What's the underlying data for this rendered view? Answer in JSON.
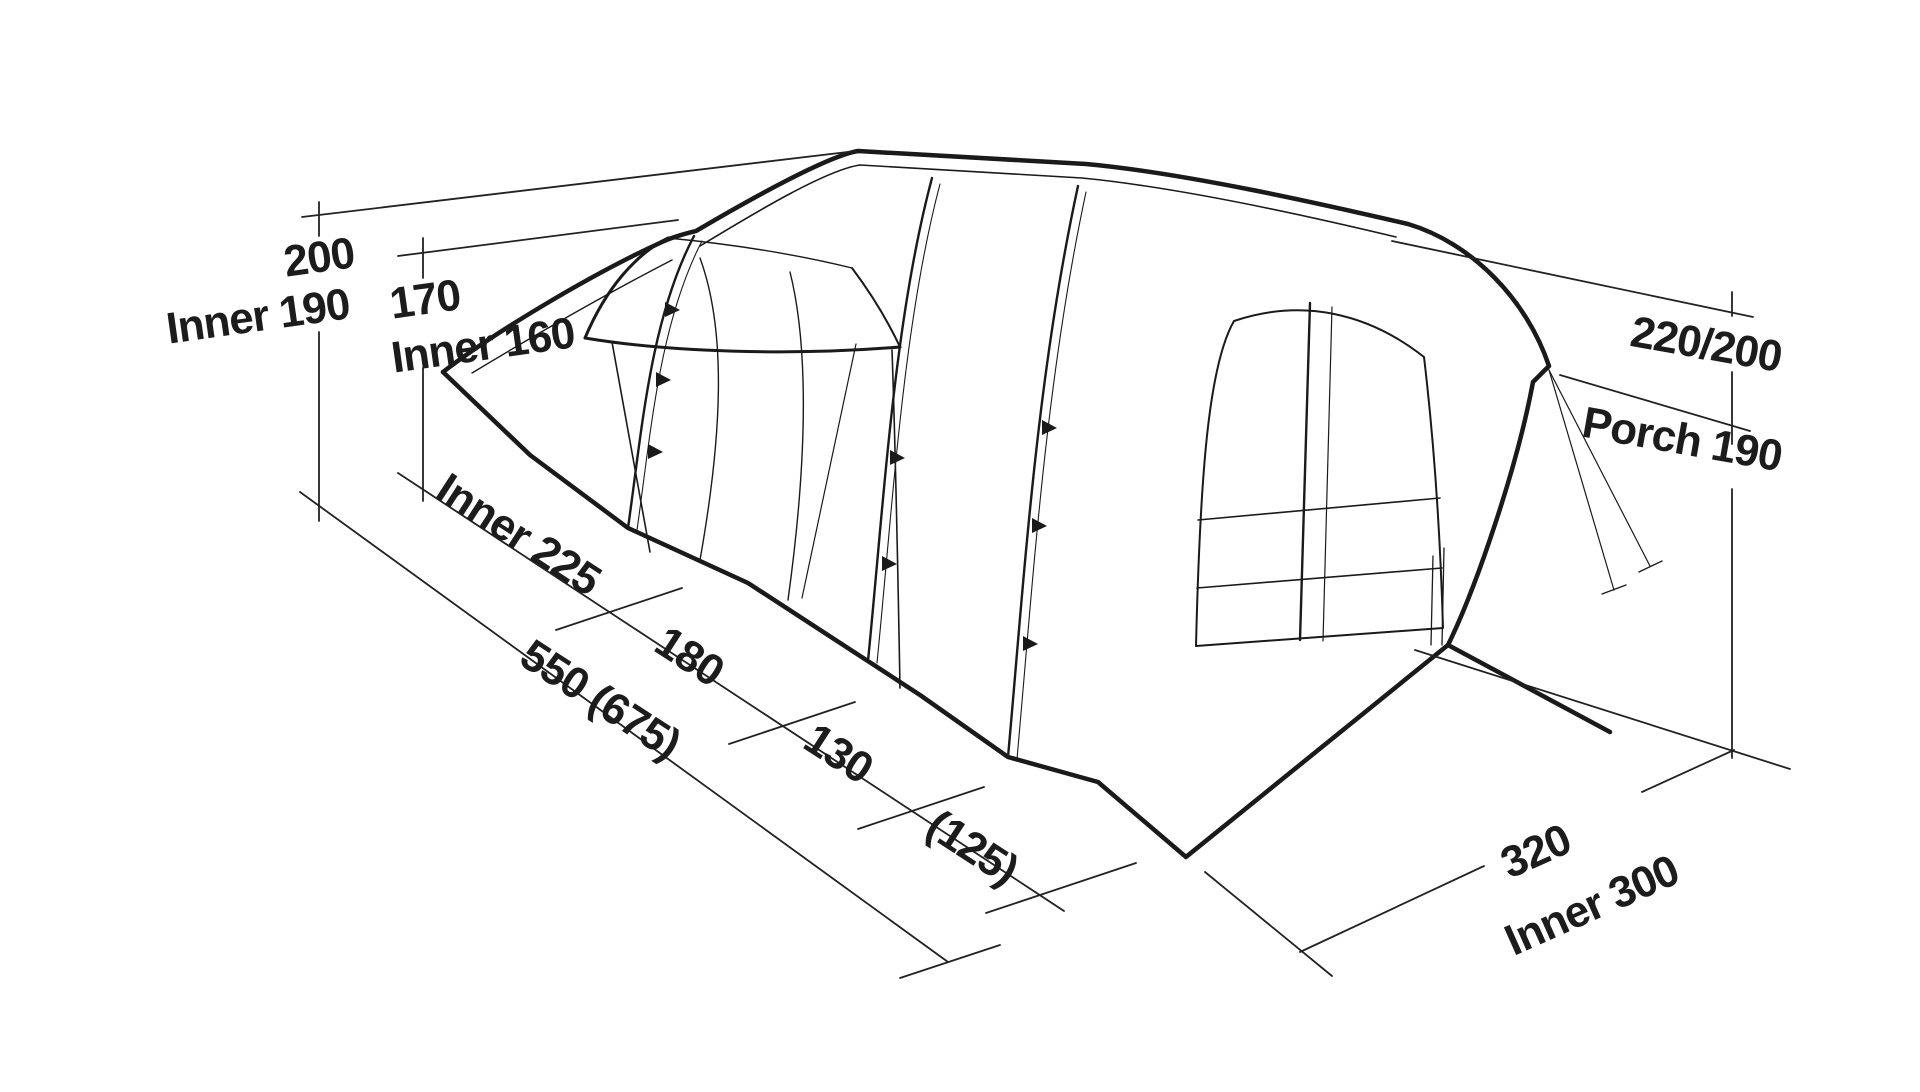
{
  "page": {
    "background_color": "#ffffff"
  },
  "diagram": {
    "kind": "tent-dimension-line-drawing",
    "line_color": "#1a1a1a",
    "dimension_line_color": "#222222",
    "labels": [
      {
        "name": "dim-height-main-outer",
        "text": "200"
      },
      {
        "name": "dim-height-main-inner",
        "text": "Inner 190"
      },
      {
        "name": "dim-height-rear-outer",
        "text": "170"
      },
      {
        "name": "dim-height-rear-inner",
        "text": "Inner 160"
      },
      {
        "name": "dim-height-porch-outer",
        "text": "220/200"
      },
      {
        "name": "dim-height-porch-inner",
        "text": "Porch 190"
      },
      {
        "name": "dim-length-inner-cabin",
        "text": "Inner 225"
      },
      {
        "name": "dim-length-mid-section",
        "text": "180"
      },
      {
        "name": "dim-length-front-section",
        "text": "130"
      },
      {
        "name": "dim-length-extension",
        "text": "(125)"
      },
      {
        "name": "dim-length-total",
        "text": "550 (675)"
      },
      {
        "name": "dim-width-outer",
        "text": "320"
      },
      {
        "name": "dim-width-inner",
        "text": "Inner 300"
      }
    ],
    "measurements": {
      "height_main": {
        "outer": "200",
        "inner": "190"
      },
      "height_rear": {
        "outer": "170",
        "inner": "160"
      },
      "height_porch": {
        "outer": "220/200",
        "porch": "190"
      },
      "length_sections": [
        "Inner 225",
        "180",
        "130",
        "(125)"
      ],
      "length_total": "550 (675)",
      "width": {
        "outer": "320",
        "inner": "300"
      }
    }
  }
}
